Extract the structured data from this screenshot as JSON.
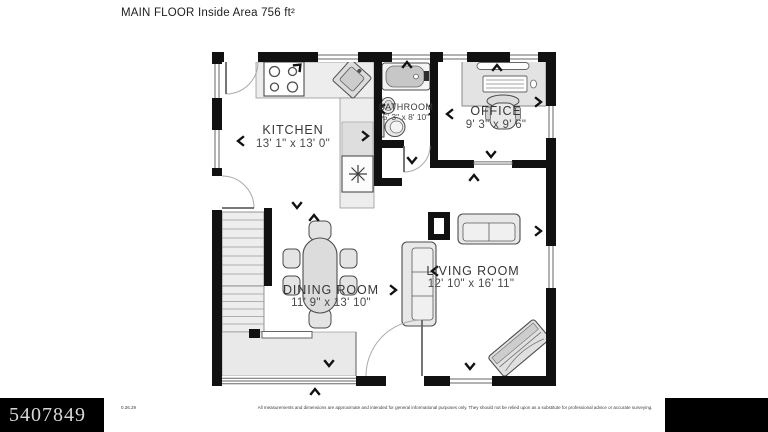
{
  "header": {
    "title": "MAIN FLOOR Inside Area 756 ft²"
  },
  "rooms": {
    "kitchen": {
      "name": "KITCHEN",
      "dims": "13' 1\" x 13' 0\""
    },
    "bathroom": {
      "name": "BATHROOM",
      "dims": "5' 3\" x 8' 10\""
    },
    "office": {
      "name": "OFFICE",
      "dims": "9' 3\" x 9' 6\""
    },
    "dining": {
      "name": "DINING ROOM",
      "dims": "11' 9\" x 13' 10\""
    },
    "living": {
      "name": "LIVING ROOM",
      "dims": "12' 10\" x 16' 11\""
    }
  },
  "footer": {
    "watermark": "5407849",
    "code": "0.26.29",
    "disclaimer": "All measurements and dimensions are approximate and intended for general informational purposes only. They should not be relied upon as a substitute for professional advice or accurate surveying."
  },
  "colors": {
    "wall": "#111111",
    "furniture_fill": "#e8e8e8",
    "furniture_stroke": "#4d4d4d",
    "label": "#3a3a3a",
    "footer_bg": "#000000"
  },
  "icons": {
    "stove": "stove-4-burners",
    "kitchen_sink": "corner-sink",
    "fridge": "refrigerator-snowflake",
    "bathtub": "bathtub",
    "toilet": "toilet",
    "bath_sink": "wall-sink",
    "desk": "desk-with-computer",
    "office_chair": "office-chair",
    "dining_set": "dining-table-6-chairs",
    "sofa": "sofa",
    "loveseat": "loveseat",
    "piano": "piano-diagonal",
    "stairs": "staircase",
    "arrows": "direction-chevrons"
  }
}
